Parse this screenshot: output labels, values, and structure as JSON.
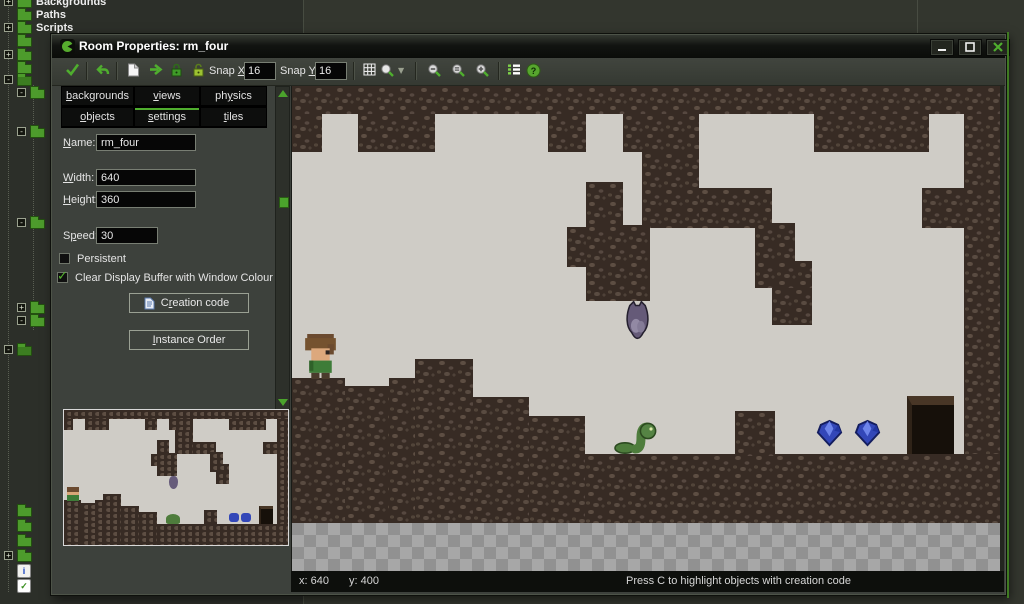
{
  "window": {
    "title": "Room Properties: rm_four"
  },
  "tree": {
    "rows": [
      {
        "y": -4,
        "expander": "+",
        "label": "Backgrounds"
      },
      {
        "y": 9,
        "label": "Paths"
      },
      {
        "y": 22,
        "expander": "+",
        "label": "Scripts"
      },
      {
        "y": 35
      },
      {
        "y": 49,
        "expander": "+"
      },
      {
        "y": 62
      },
      {
        "y": 74,
        "expander": "-",
        "open": true
      },
      {
        "y": 87,
        "indent": 1,
        "expander": "-"
      },
      {
        "y": 126,
        "indent": 1,
        "expander": "-"
      },
      {
        "y": 217,
        "indent": 1,
        "expander": "-"
      },
      {
        "y": 302,
        "indent": 1,
        "expander": "+"
      },
      {
        "y": 315,
        "indent": 1,
        "expander": "-"
      },
      {
        "y": 344,
        "expander": "-",
        "open": true
      },
      {
        "y": 505
      },
      {
        "y": 520
      },
      {
        "y": 535
      },
      {
        "y": 550,
        "expander": "+"
      },
      {
        "y": 564,
        "icon": "info"
      },
      {
        "y": 579,
        "icon": "check"
      }
    ]
  },
  "toolbar": {
    "snap_x_label": "Snap X:",
    "snap_x_value": "16",
    "snap_y_label": "Snap Y:",
    "snap_y_value": "16"
  },
  "tabs": {
    "row1": [
      {
        "label": "backgrounds"
      },
      {
        "label": "views"
      },
      {
        "label": "physics"
      }
    ],
    "row2": [
      {
        "label": "objects"
      },
      {
        "label": "settings"
      },
      {
        "label": "tiles"
      }
    ],
    "selected": "settings"
  },
  "form": {
    "name_label": "Name:",
    "name_value": "rm_four",
    "width_label": "Width:",
    "width_value": "640",
    "height_label": "Height:",
    "height_value": "360",
    "speed_label": "Speed:",
    "speed_value": "30",
    "persistent_label": "Persistent",
    "clear_buffer_label": "Clear Display Buffer with Window Colour",
    "creation_code_label": "Creation code",
    "instance_order_label": "Instance Order"
  },
  "status_bar": {
    "x": "x: 640",
    "y": "y: 400",
    "hint": "Press C to highlight objects with creation code"
  },
  "room": {
    "width_px": 708,
    "height_px": 437,
    "colors": {
      "floor_light": "#cfccc6",
      "wall_base": "#372b24",
      "wall_pebble": "#5d4e43",
      "checker_a": "#a7a7a7",
      "checker_b": "#919191",
      "accent_green": "#4fae2e"
    },
    "walls": [
      [
        0,
        0,
        708,
        28
      ],
      [
        0,
        28,
        30,
        38
      ],
      [
        66,
        28,
        77,
        38
      ],
      [
        256,
        28,
        38,
        38
      ],
      [
        331,
        28,
        76,
        38
      ],
      [
        350,
        66,
        57,
        76
      ],
      [
        522,
        28,
        115,
        38
      ],
      [
        672,
        28,
        36,
        74
      ],
      [
        294,
        96,
        37,
        45
      ],
      [
        275,
        141,
        19,
        40
      ],
      [
        294,
        139,
        64,
        76
      ],
      [
        407,
        102,
        73,
        40
      ],
      [
        463,
        137,
        40,
        38
      ],
      [
        463,
        175,
        57,
        27
      ],
      [
        480,
        202,
        40,
        37
      ],
      [
        630,
        102,
        42,
        40
      ],
      [
        672,
        102,
        36,
        268
      ],
      [
        0,
        292,
        53,
        145
      ],
      [
        53,
        300,
        44,
        137
      ],
      [
        97,
        292,
        26,
        145
      ],
      [
        123,
        273,
        58,
        164
      ],
      [
        181,
        311,
        56,
        126
      ],
      [
        237,
        330,
        56,
        107
      ],
      [
        293,
        368,
        415,
        69
      ],
      [
        443,
        325,
        40,
        45
      ]
    ],
    "door": [
      615,
      310,
      47,
      58
    ],
    "sprites": [
      {
        "type": "player",
        "x": 11,
        "y": 248,
        "w": 35,
        "h": 45
      },
      {
        "type": "bat",
        "x": 332,
        "y": 213,
        "w": 27,
        "h": 42
      },
      {
        "type": "snake",
        "x": 321,
        "y": 336,
        "w": 46,
        "h": 32
      },
      {
        "type": "gem",
        "x": 523,
        "y": 333,
        "w": 29,
        "h": 29
      },
      {
        "type": "gem",
        "x": 561,
        "y": 333,
        "w": 29,
        "h": 29
      }
    ]
  }
}
